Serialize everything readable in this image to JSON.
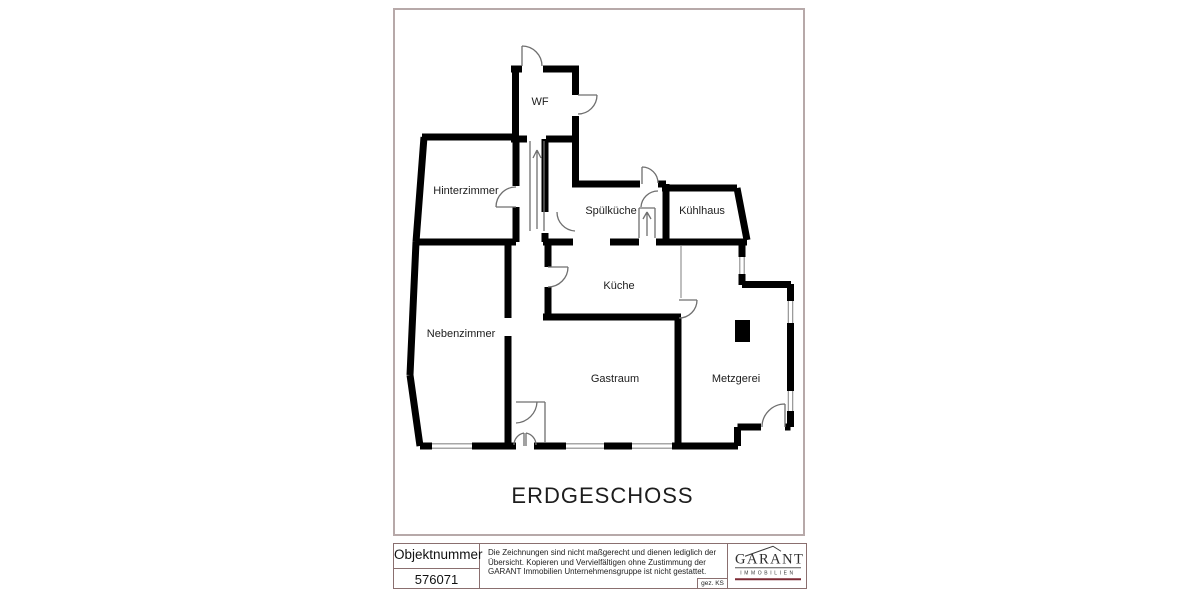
{
  "page": {
    "floor_title": "ERDGESCHOSS"
  },
  "plan": {
    "rooms": [
      {
        "label": "WF"
      },
      {
        "label": "Hinterzimmer"
      },
      {
        "label": "Spülküche"
      },
      {
        "label": "Kühlhaus"
      },
      {
        "label": "Küche"
      },
      {
        "label": "Nebenzimmer"
      },
      {
        "label": "Gastraum"
      },
      {
        "label": "Metzgerei"
      }
    ],
    "colors": {
      "wall": "#000000",
      "detail_line": "#6f6f6f",
      "sheet_frame": "#b7a9a9",
      "title_block_border": "#8a6f6f",
      "logo_text": "#2e2e2e",
      "logo_rule": "#7d2a35"
    }
  },
  "title_block": {
    "object_number_label": "Objektnummer",
    "object_number_value": "576071",
    "disclaimer": "Die Zeichnungen sind nicht maßgerecht und dienen lediglich der Übersicht. Kopieren und Vervielfältigen ohne Zustimmung der GARANT Immobilien Unternehmensgruppe ist nicht gestattet.",
    "signed": "gez. KS",
    "logo": {
      "name": "GARANT",
      "subtitle": "IMMOBILIEN"
    }
  }
}
